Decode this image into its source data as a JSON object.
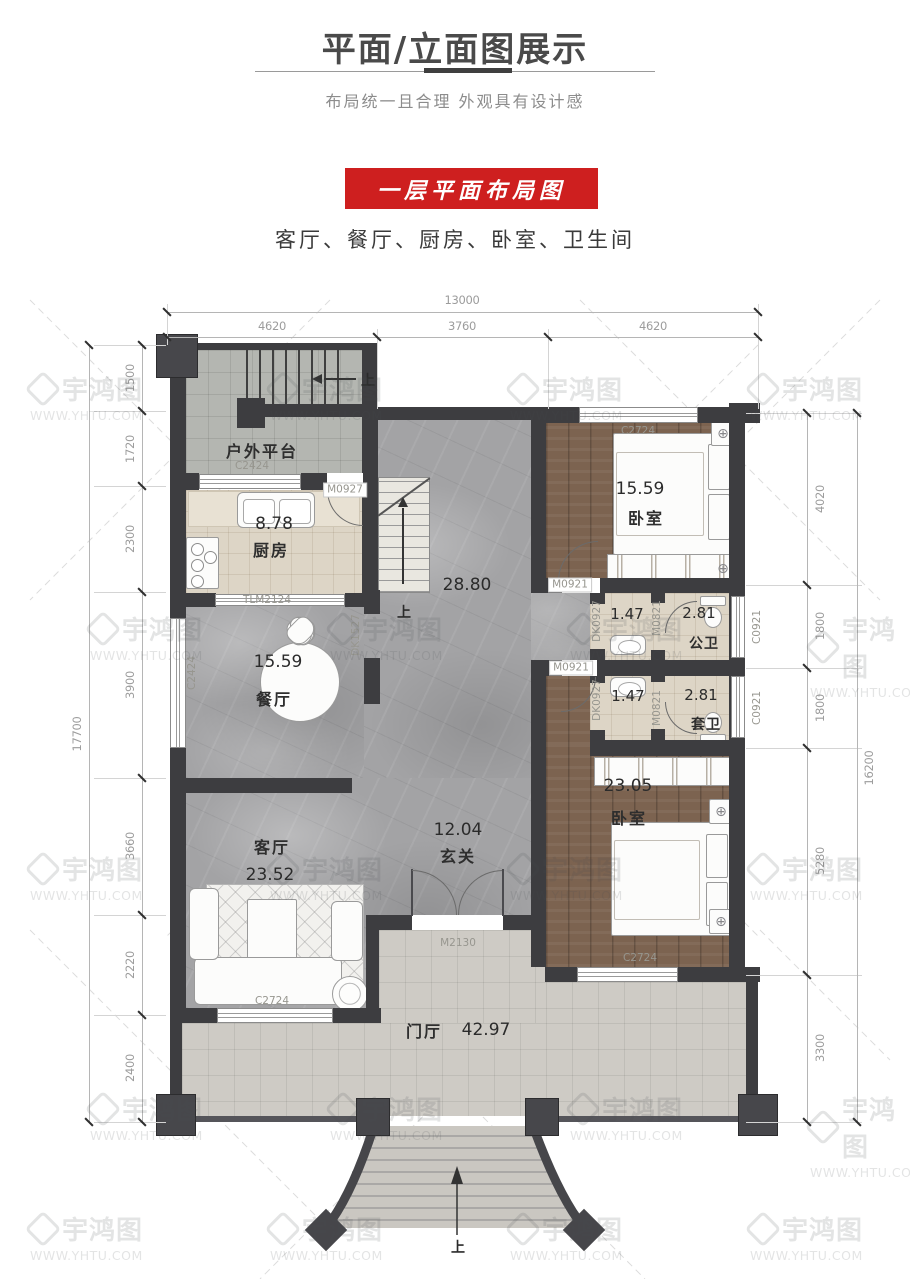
{
  "header": {
    "title": "平面/立面图展示",
    "subtitle": "布局统一且合理 外观具有设计感"
  },
  "banner": {
    "text": "一层平面布局图",
    "color": "#ce1f1f",
    "features": "客厅、餐厅、厨房、卧室、卫生间"
  },
  "watermark": {
    "brand": "宇鸿图",
    "url": "WWW.YHTU.COM"
  },
  "dimensions": {
    "top": {
      "total": "13000",
      "segments": [
        "4620",
        "3760",
        "4620"
      ]
    },
    "left": {
      "total": "17700",
      "segments": [
        "1500",
        "1720",
        "2300",
        "3900",
        "3660",
        "2220",
        "2400"
      ]
    },
    "right": {
      "total": "16200",
      "segments": [
        "4020",
        "1800",
        "1800",
        "5280",
        "3300"
      ]
    }
  },
  "rooms": {
    "platform": {
      "name": "户外平台"
    },
    "kitchen": {
      "name": "厨房",
      "area": "8.78"
    },
    "dining": {
      "name": "餐厅",
      "area": "15.59"
    },
    "living": {
      "name": "客厅",
      "area": "23.52"
    },
    "hall": {
      "area": "28.80"
    },
    "foyer": {
      "name": "玄关",
      "area": "12.04"
    },
    "porch": {
      "name": "门厅",
      "area": "42.97"
    },
    "bedroom1": {
      "name": "卧室",
      "area": "15.59"
    },
    "bedroom2": {
      "name": "卧室",
      "area": "23.05"
    },
    "bath_public": {
      "name": "公卫",
      "area": "2.81"
    },
    "bath_ensuite": {
      "name": "套卫",
      "area": "2.81"
    },
    "vestibule1": {
      "area": "1.47"
    },
    "vestibule2": {
      "area": "1.47"
    }
  },
  "fixtures": {
    "c2424": "C2424",
    "m0927": "M0927",
    "tlm2124": "TLM2124",
    "dk1527": "DK1527",
    "c2724": "C2724",
    "m0921": "M0921",
    "dk0927": "DK0927",
    "m0821": "M0821",
    "c0921": "C0921",
    "m2130": "M2130",
    "up": "上",
    "lamp_icon": "⊕"
  }
}
